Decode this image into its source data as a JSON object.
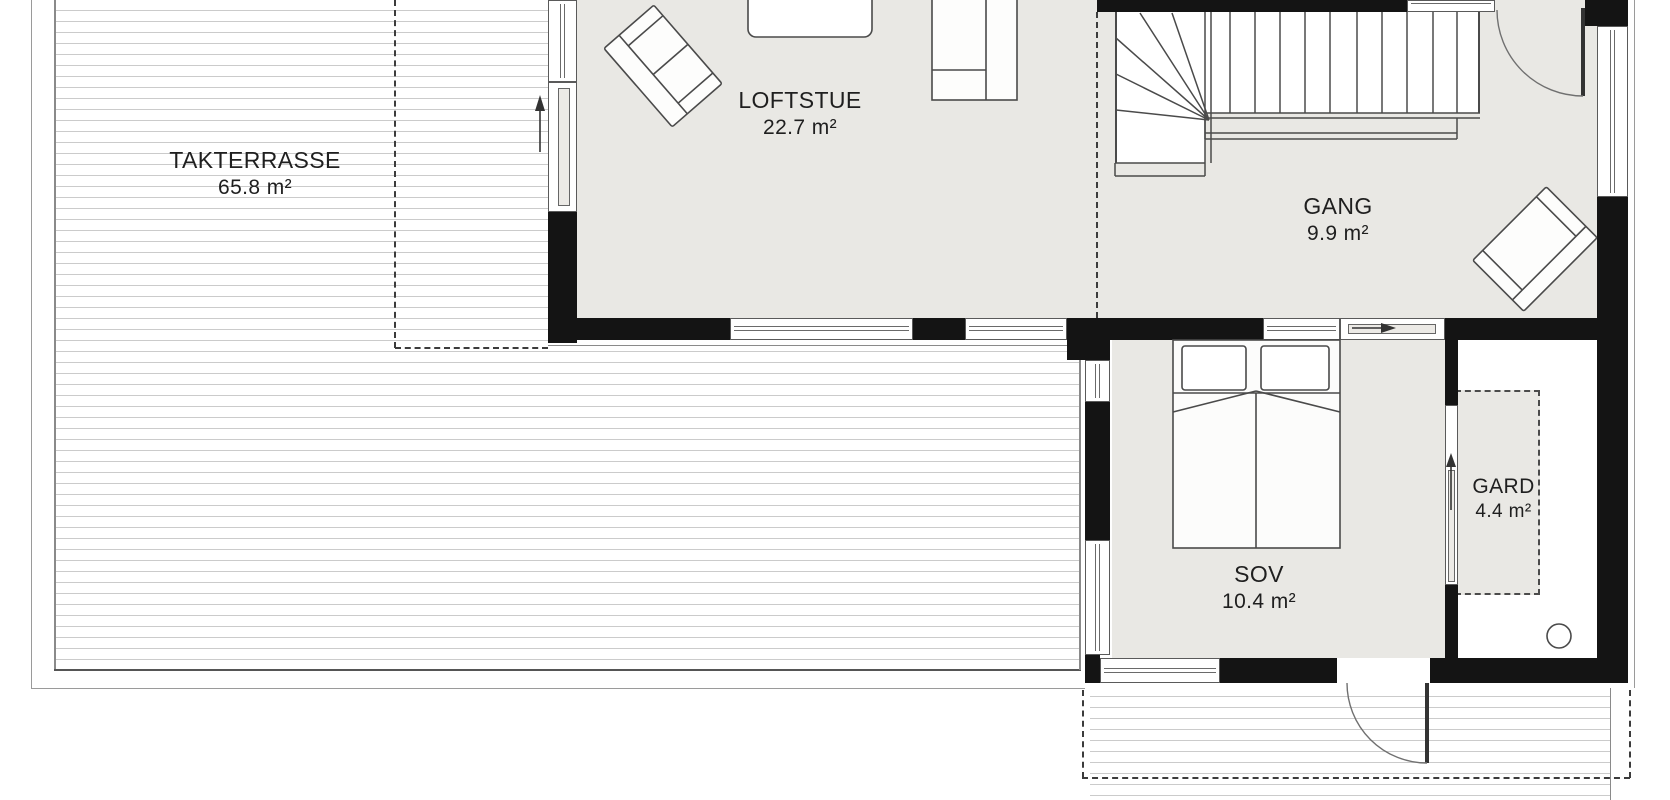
{
  "rooms": {
    "takterrasse": {
      "label": "TAKTERRASSE",
      "area": "65.8 m²"
    },
    "loftstue": {
      "label": "LOFTSTUE",
      "area": "22.7 m²"
    },
    "gang": {
      "label": "GANG",
      "area": "9.9 m²"
    },
    "sov": {
      "label": "SOV",
      "area": "10.4 m²"
    },
    "gard": {
      "label": "GARD",
      "area": "4.4 m²"
    }
  },
  "icons": {
    "terrace_door_arrow": "up-arrow",
    "sov_slider_arrow": "right-arrow",
    "gard_slider_arrow": "up-arrow"
  },
  "colors": {
    "floor": "#e9e8e4",
    "wall": "#141414",
    "outline": "#4a4a4a",
    "deck_line": "#cbcbcb",
    "dash": "#3c3c3c",
    "text": "#1f1f1f"
  }
}
